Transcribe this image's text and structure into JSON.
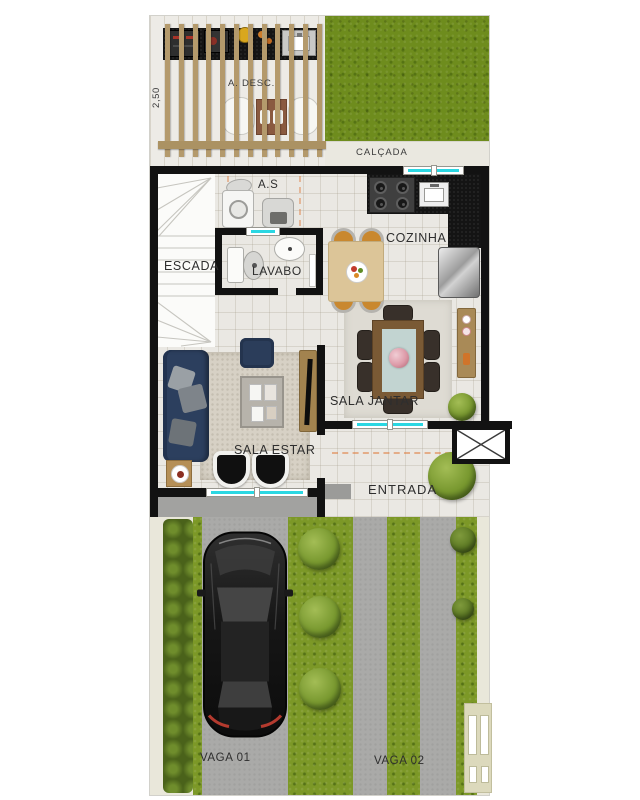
{
  "plan": {
    "labels": {
      "dimension": "2,50",
      "deck": "A. DESC.",
      "sidewalk": "CALÇADA",
      "service": "A.S",
      "stairs": "ESCADA",
      "toilet": "LAVABO",
      "kitchen": "COZINHA",
      "dining": "SALA JANTAR",
      "living": "SALA ESTAR",
      "entrance": "ENTRADA",
      "parking1": "VAGA 01",
      "parking2": "VAGA 02"
    },
    "colors": {
      "wall": "#121212",
      "window_glass": "#2bd7e2",
      "lawn": "#6e8c1d",
      "driveway_grass": "#7c9827",
      "hedge": "#55701f",
      "pergola_wood": "#b49a6c",
      "floor_tile": "#eae8e3",
      "black_counter": "#141414",
      "sofa": "#2c3f5e",
      "dining_table": "#7a5a35",
      "table_runner": "#c2d4d1",
      "kitchen_table": "#dcc598",
      "kitchen_chair": "#c9882f",
      "fridge": "#bdbdbd",
      "car_body": "#151515",
      "driveway_track": "#aaaaa8",
      "walkway": "#e9e7da",
      "living_rug": "#d7d1c5"
    }
  }
}
